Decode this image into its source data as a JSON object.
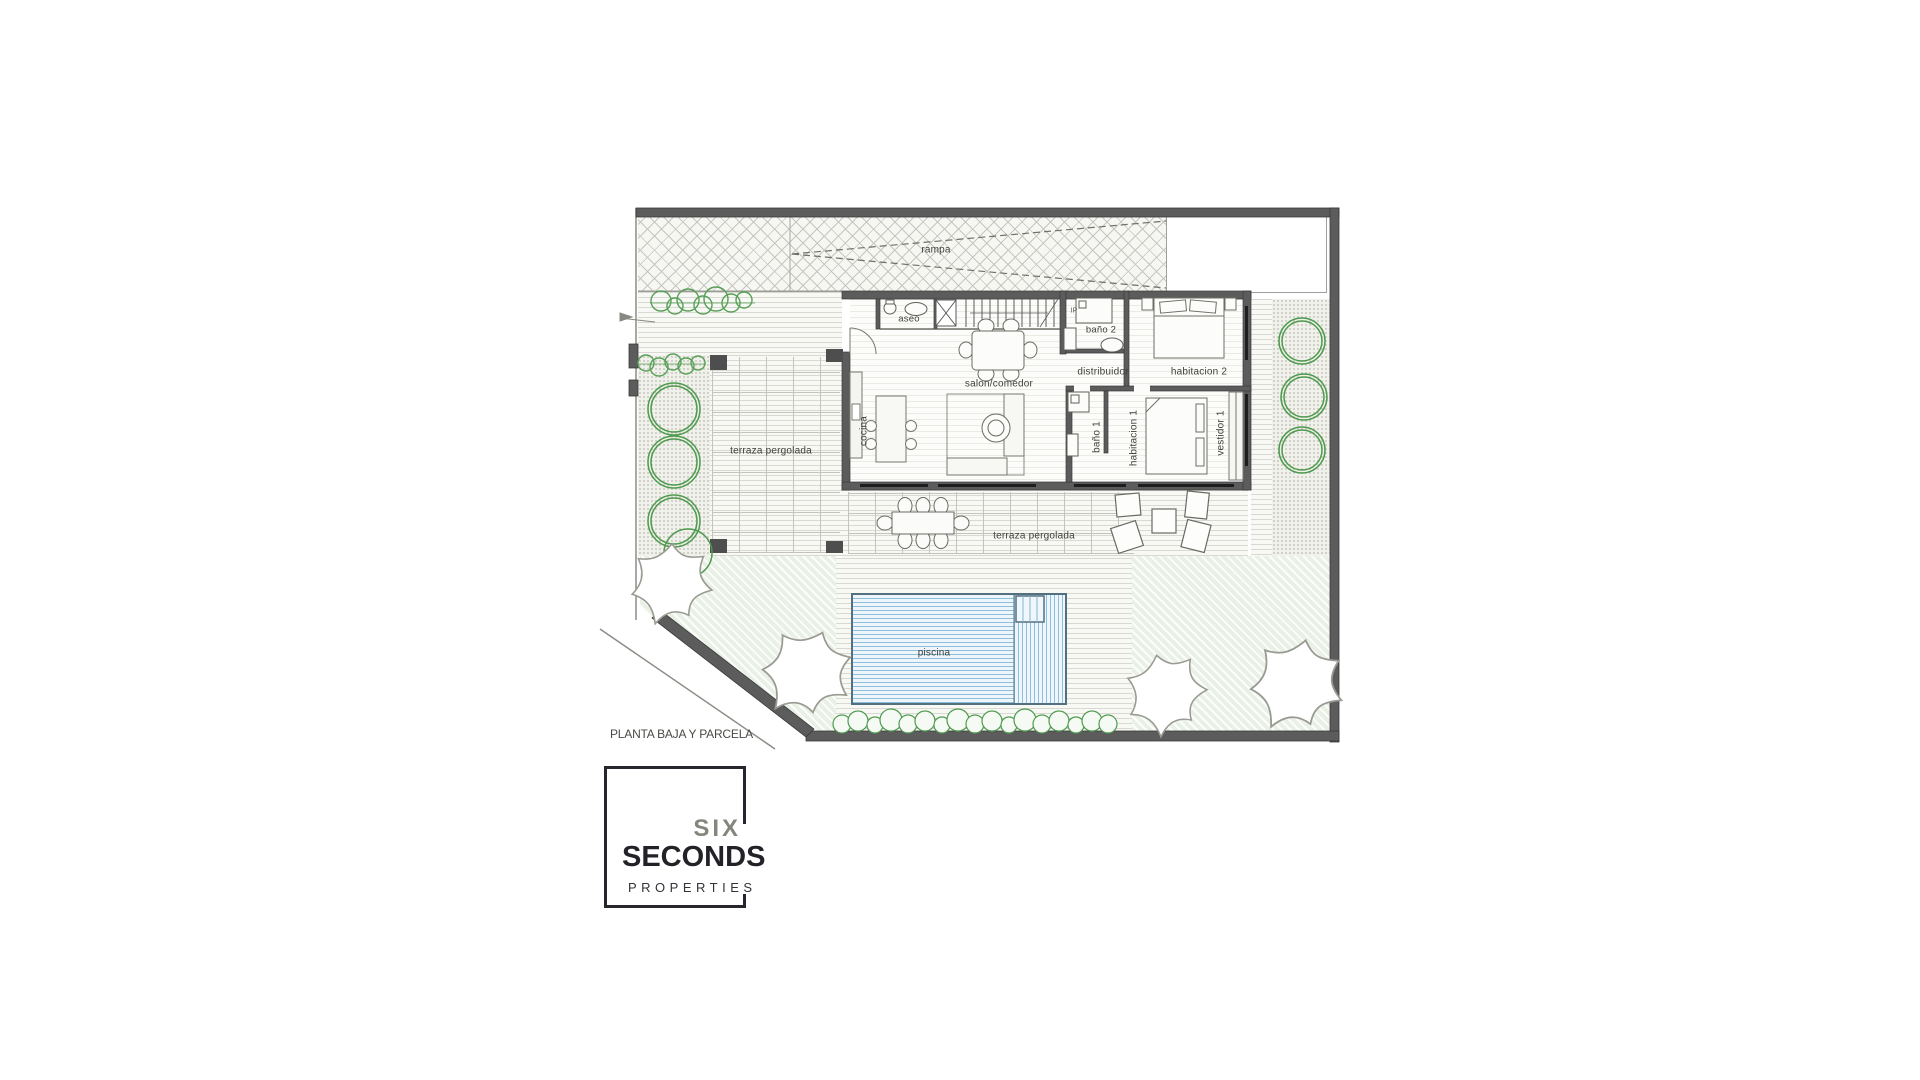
{
  "plan": {
    "caption": "PLANTA BAJA Y PARCELA",
    "labels": {
      "rampa": "rampa",
      "aseo": "aseo",
      "ip_mark": "IP",
      "bano2": "baño 2",
      "distribuidor": "distribuidor",
      "habitacion2": "habitacion 2",
      "salon_comedor": "salon/comedor",
      "cocina": "cocina",
      "bano1": "baño 1",
      "habitacion1": "habitacion 1",
      "vestidor1": "vestidor 1",
      "terraza_pergolada_izq": "terraza pergolada",
      "terraza_pergolada_inf": "terraza pergolada",
      "piscina": "piscina"
    },
    "colors": {
      "wall": "#5c5c5c",
      "tree_green": "#4f9b4f",
      "pool_blue": "#8cc0dc",
      "lawn_green": "#e9f1e6",
      "text": "#3f3f3c"
    }
  },
  "logo": {
    "line1": "SIX",
    "line2": "SECONDS",
    "line3": "PROPERTIES"
  }
}
